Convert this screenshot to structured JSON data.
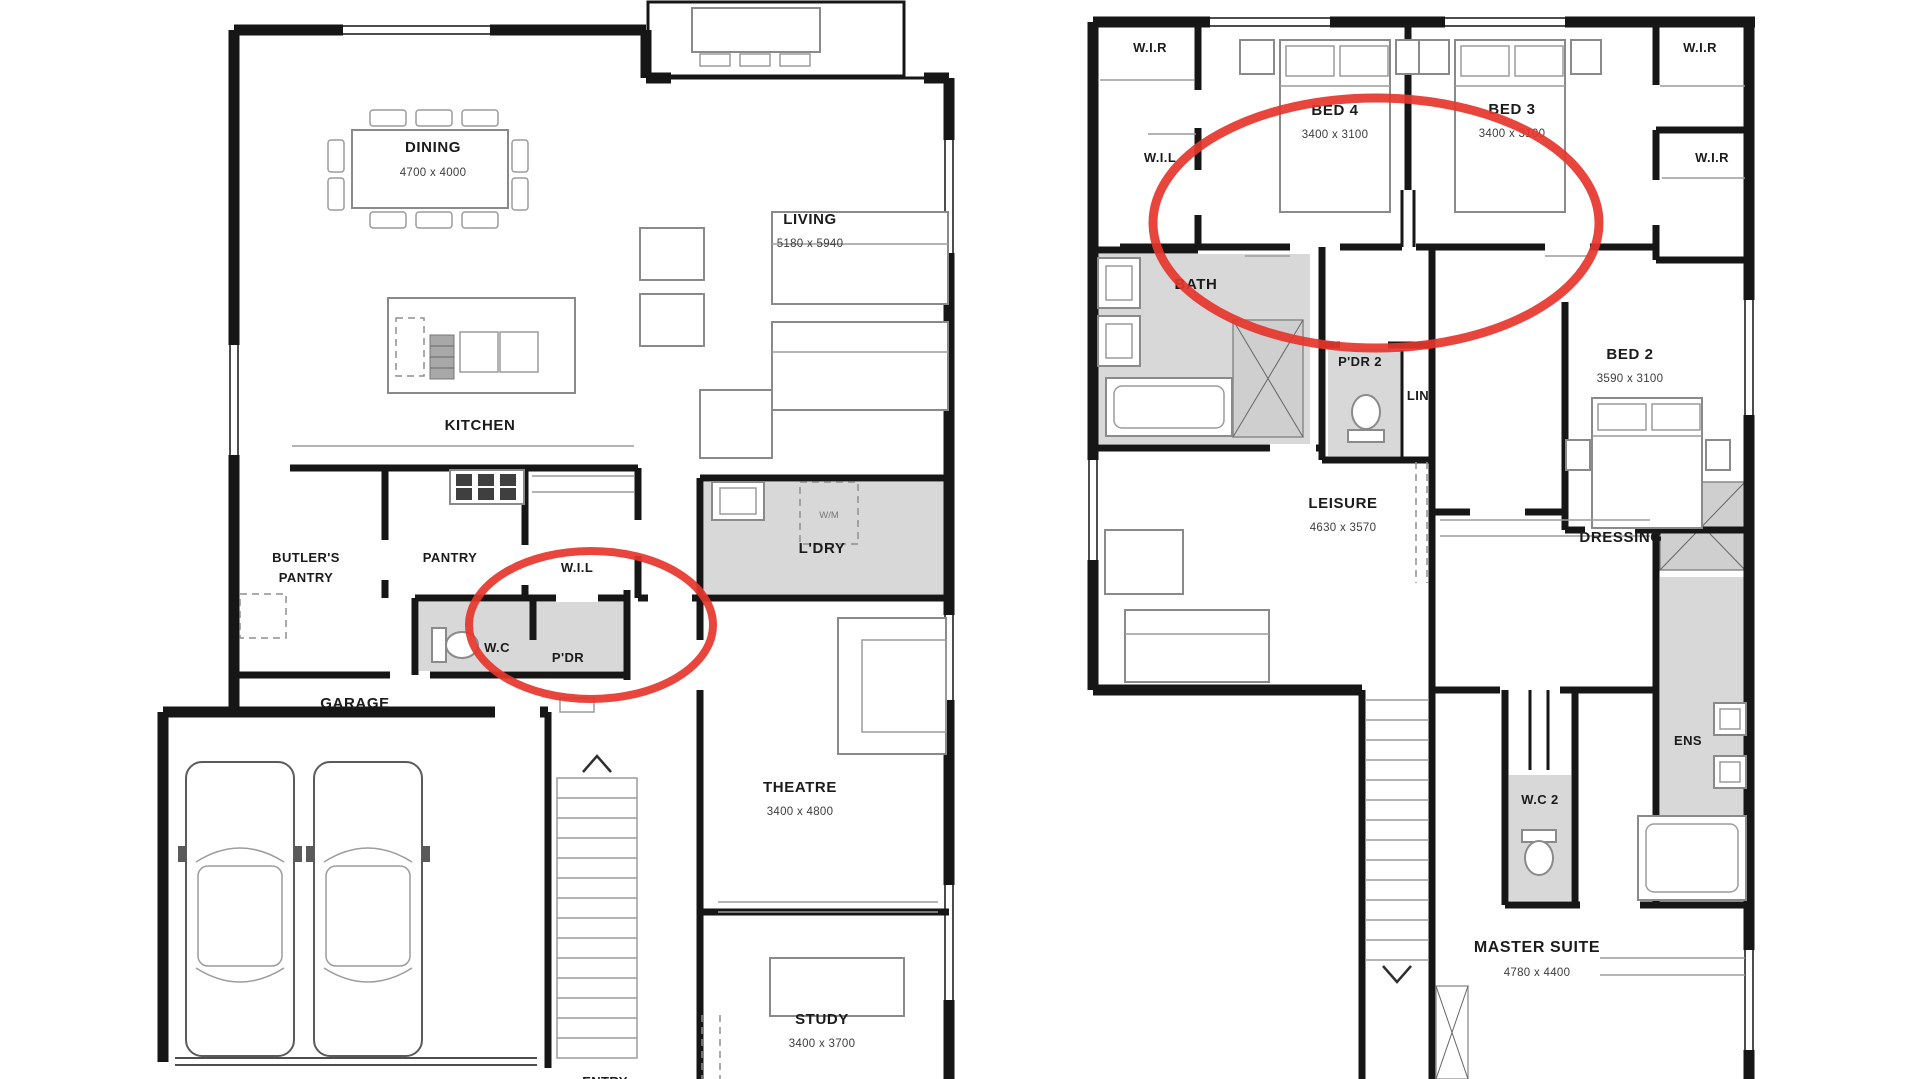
{
  "annotation": {
    "color": "#e6352b"
  },
  "ground_floor": {
    "dining": {
      "label": "DINING",
      "dims": "4700 x 4000"
    },
    "living": {
      "label": "LIVING",
      "dims": "5180 x 5940"
    },
    "kitchen": {
      "label": "KITCHEN"
    },
    "butlers_pantry": {
      "label_line1": "BUTLER'S",
      "label_line2": "PANTRY"
    },
    "pantry": {
      "label": "PANTRY"
    },
    "wil": {
      "label": "W.I.L"
    },
    "wc": {
      "label": "W.C"
    },
    "pdr": {
      "label": "P'DR"
    },
    "ldry": {
      "label": "L'DRY"
    },
    "washing_machine": {
      "label": "W/M"
    },
    "garage": {
      "label": "GARAGE"
    },
    "theatre": {
      "label": "THEATRE",
      "dims": "3400 x 4800"
    },
    "study": {
      "label": "STUDY",
      "dims": "3400 x 3700"
    },
    "entry": {
      "label": "ENTRY"
    }
  },
  "first_floor": {
    "wir_top_left": {
      "label": "W.I.R"
    },
    "wir_top_right": {
      "label": "W.I.R"
    },
    "wil": {
      "label": "W.I.L"
    },
    "wir_right": {
      "label": "W.I.R"
    },
    "bed4": {
      "label": "BED 4",
      "dims": "3400 x 3100"
    },
    "bed3": {
      "label": "BED 3",
      "dims": "3400 x 3100"
    },
    "bath": {
      "label": "BATH"
    },
    "pdr2": {
      "label": "P'DR 2"
    },
    "lin": {
      "label": "LIN"
    },
    "bed2": {
      "label": "BED 2",
      "dims": "3590 x 3100"
    },
    "leisure": {
      "label": "LEISURE",
      "dims": "4630 x 3570"
    },
    "dressing": {
      "label": "DRESSING"
    },
    "ens": {
      "label": "ENS"
    },
    "wc2": {
      "label": "W.C 2"
    },
    "master_suite": {
      "label": "MASTER SUITE",
      "dims": "4780 x 4400"
    }
  }
}
